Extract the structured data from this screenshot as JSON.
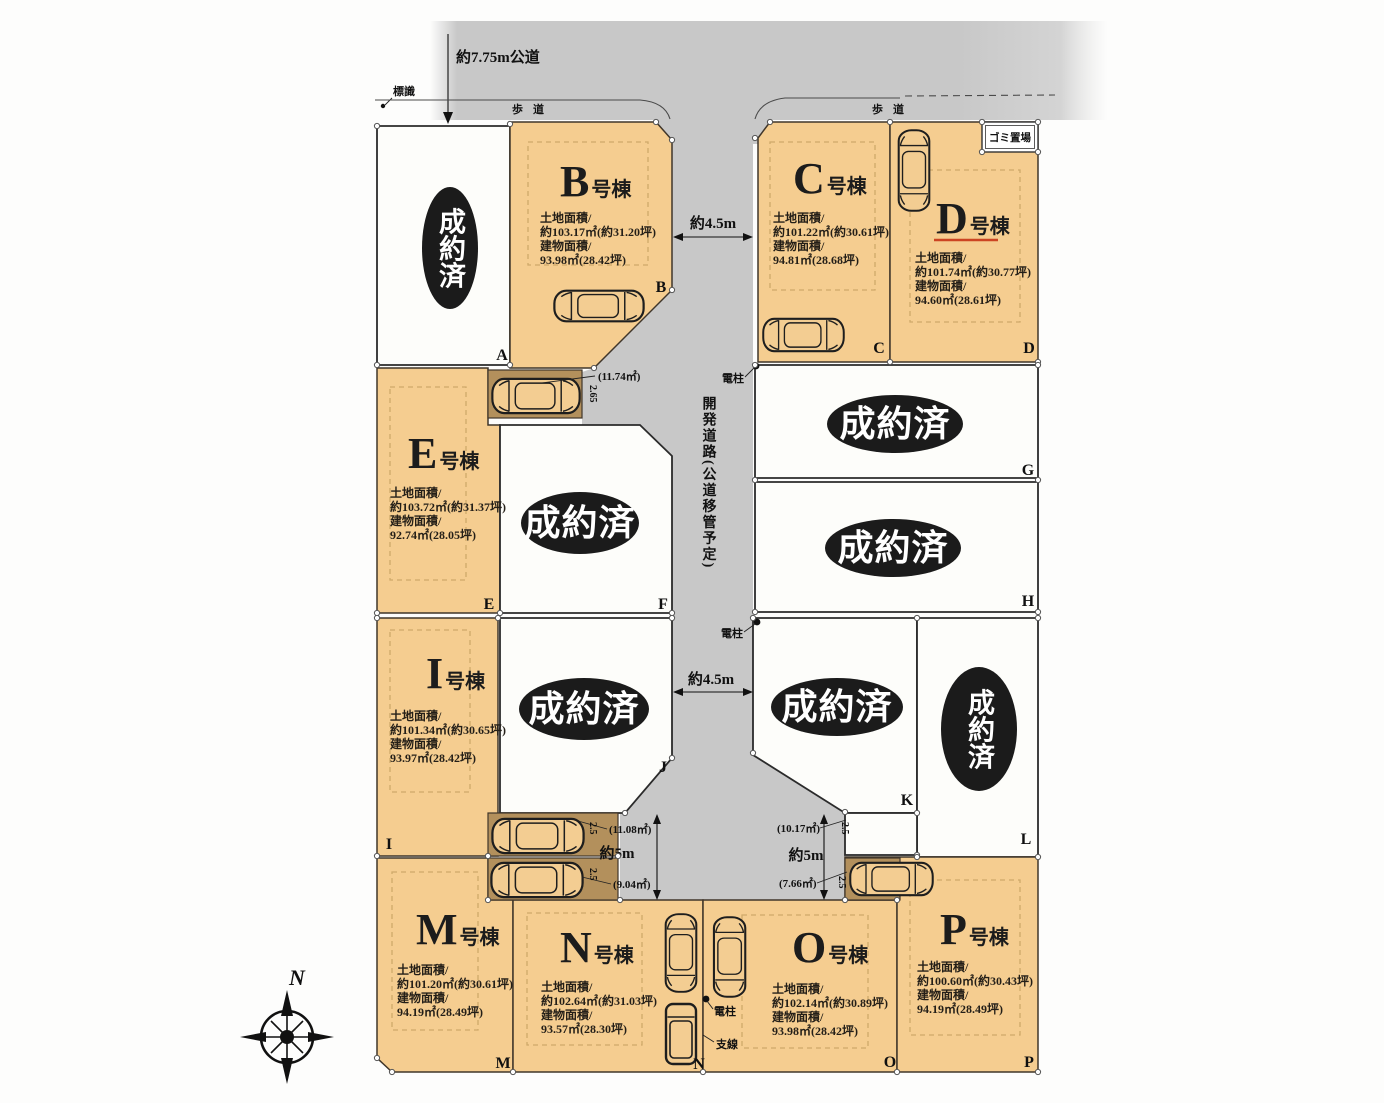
{
  "plan": {
    "top": {
      "road_label": "約7.75m公道",
      "sign_label": "標識",
      "sidewalk_left": "歩道",
      "sidewalk_right": "歩道",
      "garbage_label": "ゴミ置場"
    },
    "road": {
      "dev_road_label": "開発道路(公道移管予定)",
      "width_top": "約4.5m",
      "width_mid": "約4.5m",
      "width_left": "約5m",
      "width_right": "約5m"
    },
    "poles": {
      "pole1": "電柱",
      "pole2": "電柱",
      "pole3": "電柱",
      "wire": "支線"
    },
    "compass": {
      "north": "N"
    },
    "labels": {
      "land": "土地面積/",
      "building": "建物面積/"
    },
    "lots": {
      "A": {
        "corner": "A",
        "status": "成約済"
      },
      "B": {
        "corner": "B",
        "letter": "B",
        "suffix": "号棟",
        "land": "約103.17㎡(約31.20坪)",
        "building": "93.98㎡(28.42坪)"
      },
      "C": {
        "corner": "C",
        "letter": "C",
        "suffix": "号棟",
        "land": "約101.22㎡(約30.61坪)",
        "building": "94.81㎡(28.68坪)"
      },
      "D": {
        "corner": "D",
        "letter": "D",
        "suffix": "号棟",
        "land": "約101.74㎡(約30.77坪)",
        "building": "94.60㎡(28.61坪)"
      },
      "E": {
        "corner": "E",
        "letter": "E",
        "suffix": "号棟",
        "land": "約103.72㎡(約31.37坪)",
        "building": "92.74㎡(28.05坪)"
      },
      "F": {
        "corner": "F",
        "status": "成約済"
      },
      "G": {
        "corner": "G",
        "status": "成約済"
      },
      "H": {
        "corner": "H",
        "status": "成約済"
      },
      "I": {
        "corner": "I",
        "letter": "I",
        "suffix": "号棟",
        "land": "約101.34㎡(約30.65坪)",
        "building": "93.97㎡(28.42坪)"
      },
      "J": {
        "corner": "J",
        "status": "成約済"
      },
      "K": {
        "corner": "K",
        "status": "成約済"
      },
      "L": {
        "corner": "L",
        "status": "成約済"
      },
      "M": {
        "corner": "M",
        "letter": "M",
        "suffix": "号棟",
        "land": "約101.20㎡(約30.61坪)",
        "building": "94.19㎡(28.49坪)"
      },
      "N": {
        "corner": "N",
        "letter": "N",
        "suffix": "号棟",
        "land": "約102.64㎡(約31.03坪)",
        "building": "93.57㎡(28.30坪)"
      },
      "O": {
        "corner": "O",
        "letter": "O",
        "suffix": "号棟",
        "land": "約102.14㎡(約30.89坪)",
        "building": "93.98㎡(28.42坪)"
      },
      "P": {
        "corner": "P",
        "letter": "P",
        "suffix": "号棟",
        "land": "約100.60㎡(約30.43坪)",
        "building": "94.19㎡(28.49坪)"
      }
    },
    "parking_areas": {
      "b_north": {
        "area": "(11.74㎡)",
        "dim": "2.65"
      },
      "i_south": {
        "area": "(11.08㎡)",
        "dim": "2.5"
      },
      "m_north": {
        "area": "(9.04㎡)",
        "dim": "2.5"
      },
      "k_south": {
        "area": "(10.17㎡)",
        "dim": "2.5"
      },
      "p_north": {
        "area": "(7.66㎡)",
        "dim": "2.5"
      }
    }
  }
}
